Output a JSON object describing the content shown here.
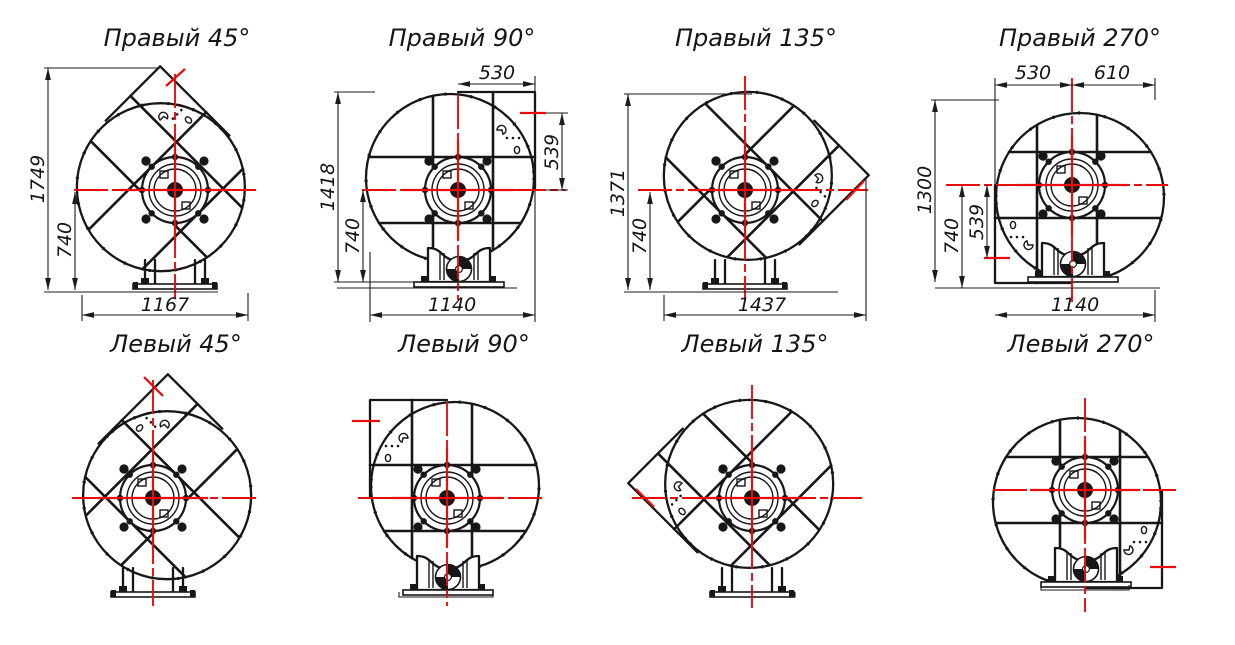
{
  "diagram": {
    "type": "fan-orientation-drawing",
    "background": "#ffffff",
    "line_color": "#171717",
    "centerline_color": "#e80c0c",
    "rows": 2,
    "columns": 4,
    "panels": [
      {
        "id": "right-45",
        "title": "Правый 45°",
        "dims": {
          "total_height": "1749",
          "axis_height": "740",
          "width": "1167"
        }
      },
      {
        "id": "right-90",
        "title": "Правый 90°",
        "dims": {
          "outlet_offset": "530",
          "outlet_height": "539",
          "total_height": "1418",
          "axis_height": "740",
          "width": "1140"
        }
      },
      {
        "id": "right-135",
        "title": "Правый 135°",
        "dims": {
          "total_height": "1371",
          "axis_height": "740",
          "width": "1437"
        }
      },
      {
        "id": "right-270",
        "title": "Правый 270°",
        "dims": {
          "outlet_offset": "530",
          "right_offset": "610",
          "total_height": "1300",
          "axis_height": "740",
          "outlet_height": "539",
          "width": "1140"
        }
      },
      {
        "id": "left-45",
        "title": "Левый 45°"
      },
      {
        "id": "left-90",
        "title": "Левый 90°"
      },
      {
        "id": "left-135",
        "title": "Левый 135°"
      },
      {
        "id": "left-270",
        "title": "Левый 270°"
      }
    ]
  }
}
